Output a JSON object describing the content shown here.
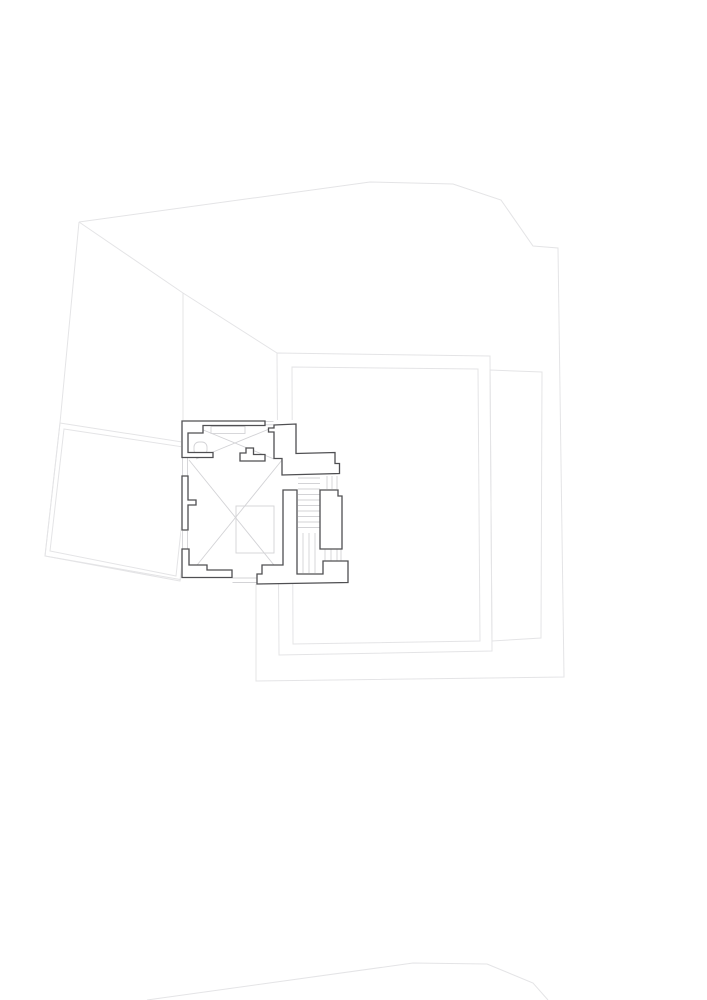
{
  "canvas": {
    "width": 707,
    "height": 1000,
    "background": "#ffffff"
  },
  "palette": {
    "site_line": "#e4e4e6",
    "detail_line": "#d3d3d6",
    "wall_line": "#4f4f52",
    "wall_fill": "#ffffff"
  },
  "site": {
    "polylines": [
      {
        "name": "site-boundary-right",
        "pts": [
          [
            79,
            222
          ],
          [
            370,
            182
          ],
          [
            453,
            184
          ],
          [
            501,
            200
          ],
          [
            533,
            246
          ],
          [
            558,
            248
          ],
          [
            564,
            677
          ],
          [
            256,
            681
          ],
          [
            256,
            584
          ]
        ]
      },
      {
        "name": "site-boundary-left",
        "pts": [
          [
            79,
            222
          ],
          [
            60,
            423
          ],
          [
            45,
            556
          ],
          [
            183,
            580
          ]
        ]
      },
      {
        "name": "roof-ridge-line",
        "pts": [
          [
            79,
            222
          ],
          [
            183,
            293
          ],
          [
            277,
            353
          ]
        ]
      },
      {
        "name": "hidden-edge-line",
        "pts": [
          [
            183,
            293
          ],
          [
            183,
            421
          ]
        ]
      },
      {
        "name": "road-edge-line",
        "pts": [
          [
            147,
            1000
          ],
          [
            413,
            963
          ],
          [
            487,
            964
          ],
          [
            533,
            983
          ],
          [
            548,
            1000
          ]
        ]
      }
    ],
    "polygons": [
      {
        "name": "terrace-left-outer",
        "pts": [
          [
            60,
            423
          ],
          [
            195,
            444
          ],
          [
            180,
            581
          ],
          [
            45,
            556
          ]
        ]
      },
      {
        "name": "terrace-left-inner",
        "pts": [
          [
            64,
            429
          ],
          [
            190,
            448
          ],
          [
            176,
            576
          ],
          [
            50,
            551
          ]
        ]
      },
      {
        "name": "courtyard-outer",
        "pts": [
          [
            277,
            353
          ],
          [
            490,
            356
          ],
          [
            492,
            651
          ],
          [
            279,
            655
          ]
        ]
      },
      {
        "name": "courtyard-inner",
        "pts": [
          [
            292,
            367
          ],
          [
            478,
            369
          ],
          [
            480,
            641
          ],
          [
            293,
            644
          ]
        ]
      },
      {
        "name": "courtyard-right",
        "pts": [
          [
            490,
            370
          ],
          [
            542,
            372
          ],
          [
            541,
            638
          ],
          [
            492,
            641
          ]
        ]
      }
    ]
  },
  "plan": {
    "footprint": [
      [
        181,
        420
      ],
      [
        298,
        420
      ],
      [
        298,
        451
      ],
      [
        341,
        451
      ],
      [
        341,
        461
      ],
      [
        349,
        461
      ],
      [
        349,
        584
      ],
      [
        181,
        584
      ]
    ],
    "walls": [
      {
        "name": "wall-top-left",
        "d": "M182,421 L265,421 L265,425.5 L203,425.5 L203,433 L188,433 L188,452.5 L213,452.5 L213,457.5 L182,457.5 Z"
      },
      {
        "name": "wall-top-right",
        "d": "M274,425 L296,424 L296,453.5 L335,452.5 L335,463.5 L339.5,463.5 L339.5,473.5 L282,475 L282,458.5 L274,458.5 L274,432 L268.5,432 L268.5,428 L274,428 Z"
      },
      {
        "name": "wall-flue",
        "d": "M246,448 L253.5,448 L253.5,454.5 L265,454.5 L265,461 L240,461 L240,453 L246,453 Z"
      },
      {
        "name": "wall-left-middle",
        "d": "M182,476 L188,476 L188,500 L196,500 L196,505 L188,505 L188,530 L182,530 Z"
      },
      {
        "name": "wall-bottom-left",
        "d": "M182,549 L189,549 L189,565 L207,565 L207,570 L232,570 L232,577.5 L182,577.5 Z"
      },
      {
        "name": "wall-stair-core",
        "d": "M283,490 L297,490 L297,574 L323,574 L323,561 L348,561 L348,582.5 L257,584 L257,574 L262,574 L262,565 L283,565 Z"
      },
      {
        "name": "wall-stair-right",
        "d": "M320,490 L338,490 L338,496 L342,496 L342,549 L320,549 Z"
      }
    ],
    "detail_groups": [
      {
        "name": "cross-brace-upper-room",
        "lines": [
          [
            196,
            427,
            274,
            459
          ],
          [
            274,
            427,
            196,
            459
          ]
        ]
      },
      {
        "name": "cross-brace-hall",
        "lines": [
          [
            189,
            460,
            282,
            575
          ],
          [
            282,
            460,
            189,
            575
          ]
        ]
      },
      {
        "name": "stair-treads",
        "lines": [
          [
            298,
            478,
            320,
            478
          ],
          [
            298,
            483.5,
            320,
            483.5
          ],
          [
            298,
            489,
            320,
            489
          ],
          [
            298,
            494.5,
            320,
            494.5
          ],
          [
            298,
            500,
            320,
            500
          ],
          [
            298,
            505.5,
            320,
            505.5
          ],
          [
            298,
            511,
            320,
            511
          ],
          [
            298,
            516.5,
            320,
            516.5
          ],
          [
            298,
            522,
            320,
            522
          ],
          [
            298,
            527.5,
            320,
            527.5
          ]
        ]
      },
      {
        "name": "stair-balustrade",
        "lines": [
          [
            327,
            476,
            327,
            489
          ],
          [
            332,
            476,
            332,
            489
          ],
          [
            337,
            476,
            337,
            489
          ]
        ]
      },
      {
        "name": "stair-rails-lower",
        "lines": [
          [
            303,
            533,
            303,
            573
          ],
          [
            309,
            533,
            309,
            573
          ],
          [
            315,
            533,
            315,
            573
          ]
        ]
      },
      {
        "name": "window-top",
        "lines": [
          [
            265.5,
            421.5,
            273.5,
            421.5
          ],
          [
            265.5,
            424.8,
            273.5,
            424.8
          ]
        ]
      },
      {
        "name": "window-left-upper",
        "lines": [
          [
            182.5,
            458,
            182.5,
            475.5
          ],
          [
            187.5,
            458,
            187.5,
            475.5
          ]
        ]
      },
      {
        "name": "window-left-lower",
        "lines": [
          [
            182.5,
            531,
            182.5,
            548.5
          ],
          [
            187.5,
            531,
            187.5,
            548.5
          ]
        ]
      },
      {
        "name": "window-bottom",
        "lines": [
          [
            232.5,
            578,
            256.5,
            578
          ],
          [
            232.5,
            582.5,
            256.5,
            582.5
          ]
        ]
      },
      {
        "name": "window-right",
        "lines": [
          [
            325,
            549.5,
            325,
            560.5
          ],
          [
            331,
            549.5,
            331,
            560.5
          ],
          [
            337,
            549.5,
            337,
            560.5
          ],
          [
            341,
            549.5,
            341,
            560.5
          ]
        ]
      }
    ],
    "detail_rects": [
      {
        "name": "skylight-void",
        "x": 236,
        "y": 506,
        "w": 38,
        "h": 47,
        "r": 0
      },
      {
        "name": "cupboard",
        "x": 211,
        "y": 426.5,
        "w": 34,
        "h": 7,
        "r": 0
      },
      {
        "name": "wc-fixture",
        "x": 194,
        "y": 442,
        "w": 13,
        "h": 13,
        "r": 5
      }
    ]
  }
}
